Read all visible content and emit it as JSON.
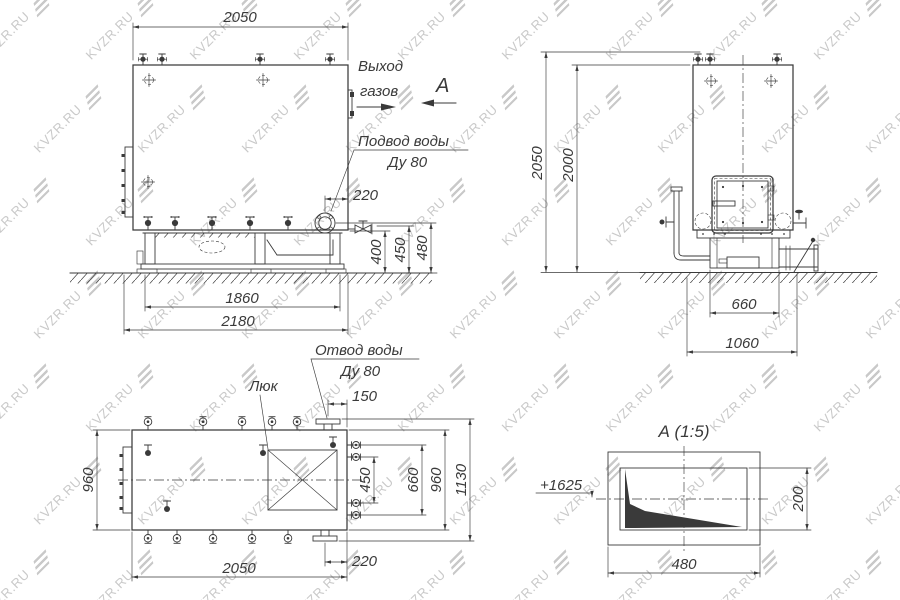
{
  "watermark": {
    "text": "KVZR.RU"
  },
  "colors": {
    "line": "#3a3a3a",
    "watermark": "#c9c9c9"
  },
  "side_view": {
    "dim_width_top": "2050",
    "dim_flange": "220",
    "dim_h1": "400",
    "dim_h2": "450",
    "dim_h3": "480",
    "dim_base": "1860",
    "dim_overall": "2180",
    "label_gas_out_1": "Выход",
    "label_gas_out_2": "газов",
    "view_letter": "А",
    "label_inlet_1": "Подвод воды",
    "label_inlet_2": "Ду 80"
  },
  "front_view": {
    "dim_h_overall": "2050",
    "dim_h_body": "2000",
    "dim_base": "660",
    "dim_overall": "1060"
  },
  "plan_view": {
    "label_hatch": "Люк",
    "label_outlet_1": "Отвод воды",
    "label_outlet_2": "Ду 80",
    "dim_flange_top": "150",
    "dim_width_left": "960",
    "dim_v450": "450",
    "dim_v660": "660",
    "dim_v960": "960",
    "dim_v1130": "1130",
    "dim_flange_bottom": "220",
    "dim_length": "2050"
  },
  "detail_view": {
    "title": "А (1:5)",
    "elevation": "+1625",
    "dim_width": "480",
    "dim_height": "200"
  }
}
